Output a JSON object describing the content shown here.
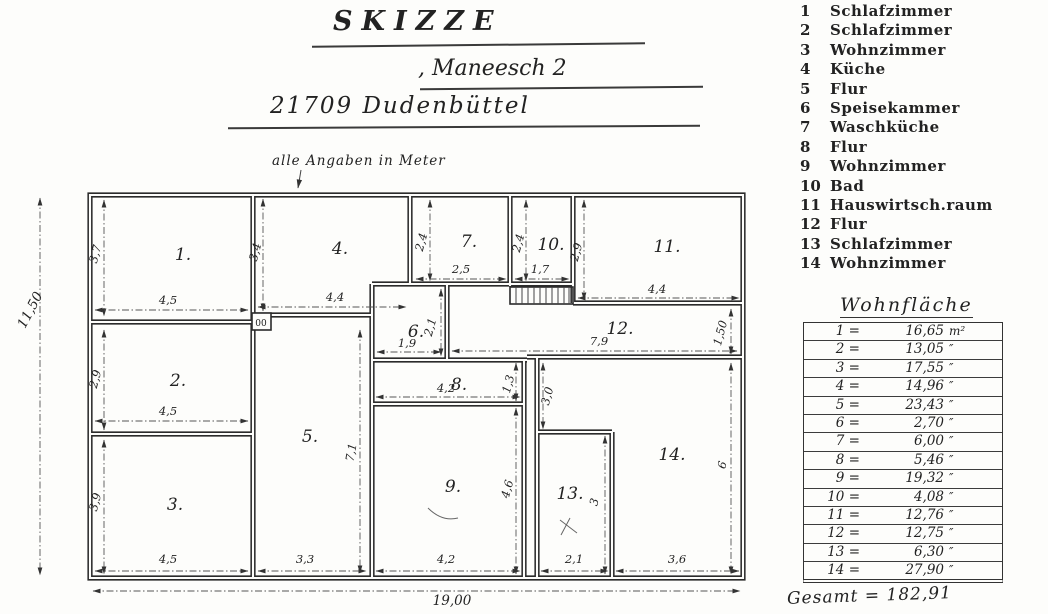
{
  "header": {
    "title": "SKIZZE",
    "address_line": ", Maneesch 2",
    "city_line": "21709 Dudenbüttel",
    "note": "alle Angaben in Meter"
  },
  "legend": {
    "items": [
      {
        "num": "1",
        "name": "Schlafzimmer"
      },
      {
        "num": "2",
        "name": "Schlafzimmer"
      },
      {
        "num": "3",
        "name": "Wohnzimmer"
      },
      {
        "num": "4",
        "name": "Küche"
      },
      {
        "num": "5",
        "name": "Flur"
      },
      {
        "num": "6",
        "name": "Speisekammer"
      },
      {
        "num": "7",
        "name": "Waschküche"
      },
      {
        "num": "8",
        "name": "Flur"
      },
      {
        "num": "9",
        "name": "Wohnzimmer"
      },
      {
        "num": "10",
        "name": "Bad"
      },
      {
        "num": "11",
        "name": "Hauswirtsch.raum"
      },
      {
        "num": "12",
        "name": "Flur"
      },
      {
        "num": "13",
        "name": "Schlafzimmer"
      },
      {
        "num": "14",
        "name": "Wohnzimmer"
      }
    ]
  },
  "plan": {
    "rooms": {
      "r1": "1.",
      "r2": "2.",
      "r3": "3.",
      "r4": "4.",
      "r5": "5.",
      "r6": "6.",
      "r7": "7.",
      "r8": "8.",
      "r9": "9.",
      "r10": "10.",
      "r11": "11.",
      "r12": "12.",
      "r13": "13.",
      "r14": "14."
    },
    "dims": {
      "overall_h": "11,50",
      "overall_w": "19,00",
      "r1_h": "3,7",
      "r1_w": "4,5",
      "r2_h": "2,9",
      "r2_w": "4,5",
      "r3_h": "3,9",
      "r3_w": "4,5",
      "r4_h": "3,4",
      "r4_w": "4,4",
      "r5_h": "7,1",
      "r5_w": "3,3",
      "r6_h": "2,1",
      "r6_w": "1,9",
      "r7_h": "2,4",
      "r7_w": "2,5",
      "r8_h": "1,3",
      "r8_w": "4,2",
      "r9_h": "4,6",
      "r9_w": "4,2",
      "r10_h": "2,4",
      "r10_w": "1,7",
      "r11_h": "2,9",
      "r11_w": "4,4",
      "r12_w": "7,9",
      "r12_h": "1,50",
      "r13_h": "3",
      "r13_w": "2,1",
      "r14_h": "6",
      "r14_w": "3,6",
      "mid_h": "3,0",
      "shaft": "00"
    }
  },
  "area_table": {
    "title": "Wohnfläche",
    "rows": [
      {
        "label": "1 =",
        "value": "16,65",
        "unit": "m²"
      },
      {
        "label": "2 =",
        "value": "13,05",
        "unit": "″"
      },
      {
        "label": "3 =",
        "value": "17,55",
        "unit": "″"
      },
      {
        "label": "4 =",
        "value": "14,96",
        "unit": "″"
      },
      {
        "label": "5 =",
        "value": "23,43",
        "unit": "″"
      },
      {
        "label": "6 =",
        "value": "2,70",
        "unit": "″"
      },
      {
        "label": "7 =",
        "value": "6,00",
        "unit": "″"
      },
      {
        "label": "8 =",
        "value": "5,46",
        "unit": "″"
      },
      {
        "label": "9 =",
        "value": "19,32",
        "unit": "″"
      },
      {
        "label": "10 =",
        "value": "4,08",
        "unit": "″"
      },
      {
        "label": "11 =",
        "value": "12,76",
        "unit": "″"
      },
      {
        "label": "12 =",
        "value": "12,75",
        "unit": "″"
      },
      {
        "label": "13 =",
        "value": "6,30",
        "unit": "″"
      },
      {
        "label": "14 =",
        "value": "27,90",
        "unit": "″"
      }
    ],
    "total": "Gesamt = 182,91"
  }
}
